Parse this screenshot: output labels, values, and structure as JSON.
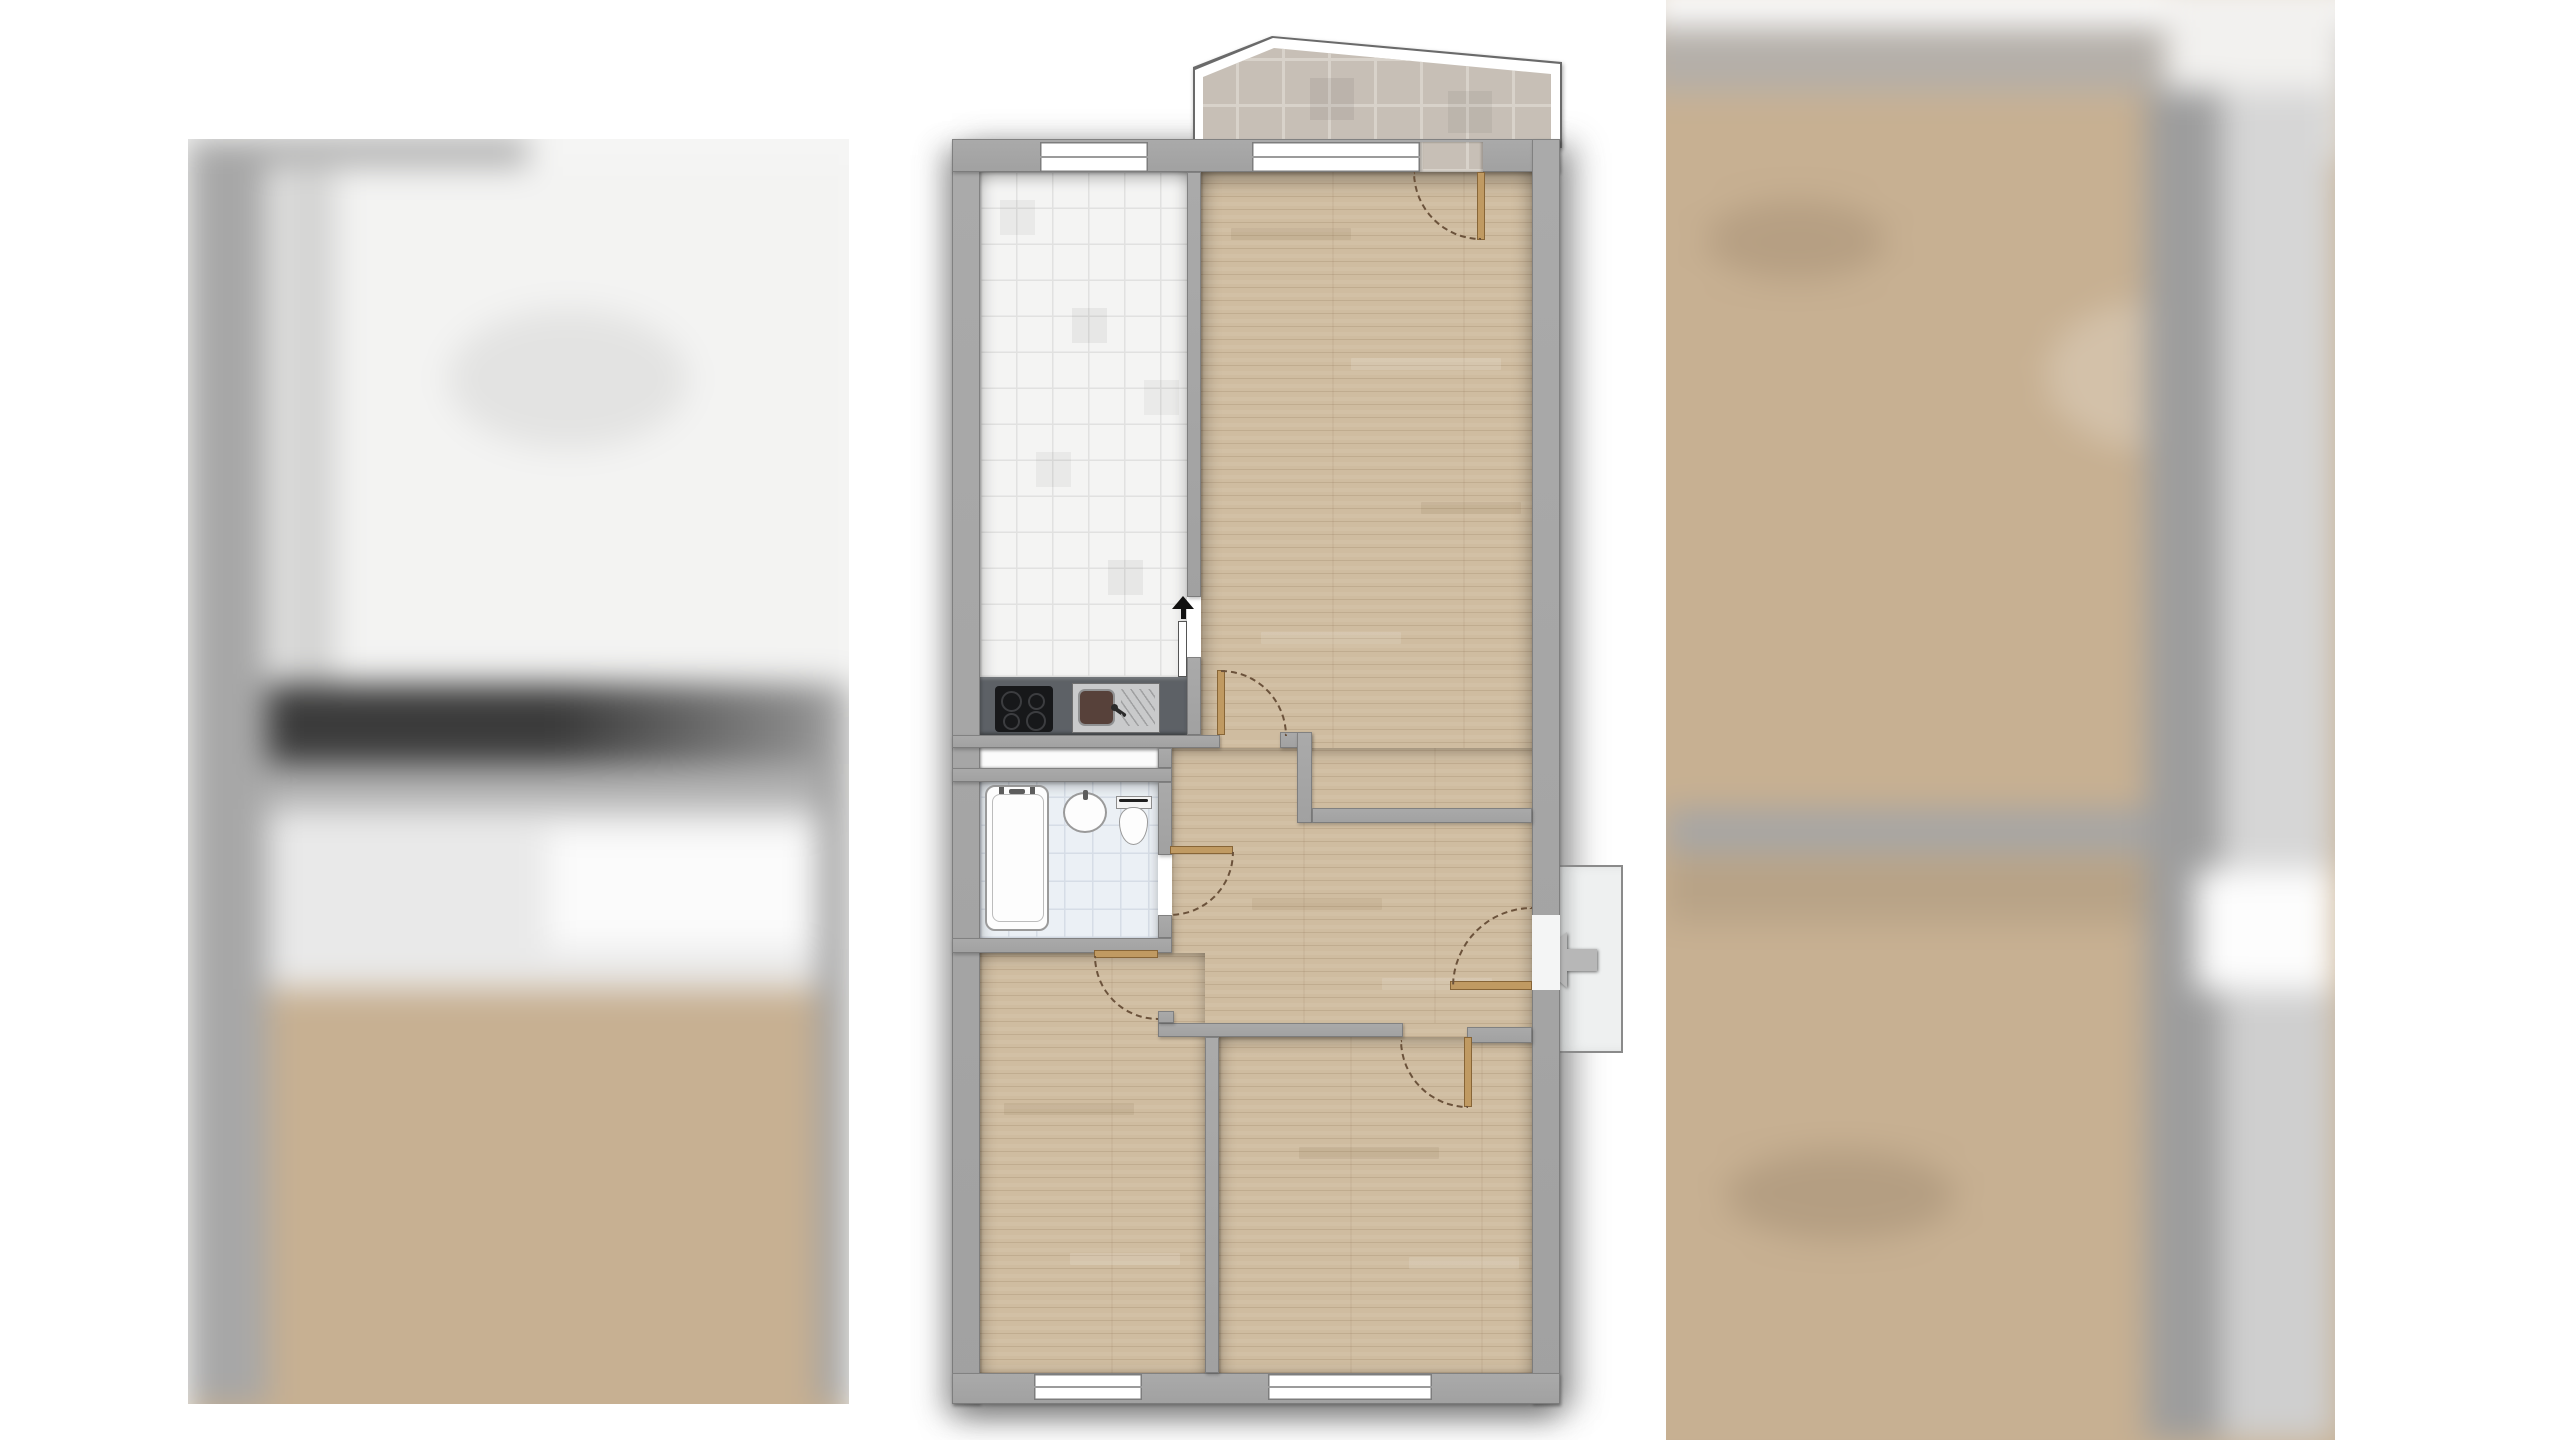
{
  "page": {
    "background": "#ffffff",
    "content": "apartment floor plan shown in an image gallery between two blurred neighbouring images"
  },
  "gallery": {
    "left_thumbnail": {
      "description": "blurred floor plan image (kitchen counter and wood rooms visible as colour blobs)"
    },
    "right_thumbnail": {
      "description": "blurred floor plan image (wood rooms and grey walls visible as colour blobs)"
    }
  },
  "floorplan": {
    "rooms": [
      {
        "id": "balcony",
        "floor": "beige ceramic tiles",
        "position": "top, outside main outline, slanted white railing"
      },
      {
        "id": "kitchen",
        "floor": "white tiles",
        "position": "top-left",
        "fixtures": [
          "counter",
          "cooktop",
          "kitchen-sink"
        ]
      },
      {
        "id": "living-room",
        "floor": "wood parquet",
        "position": "top-right"
      },
      {
        "id": "bathroom",
        "floor": "blue-grey tiles",
        "position": "middle-left",
        "fixtures": [
          "bathtub",
          "washbasin",
          "toilet"
        ]
      },
      {
        "id": "hallway",
        "floor": "wood parquet",
        "position": "middle-right"
      },
      {
        "id": "room-bottom-left",
        "floor": "wood parquet",
        "position": "bottom-left"
      },
      {
        "id": "room-bottom-right",
        "floor": "wood parquet",
        "position": "bottom-right"
      }
    ],
    "windows": [
      {
        "id": "kitchen-window",
        "wall": "top"
      },
      {
        "id": "living-room-window",
        "wall": "top"
      },
      {
        "id": "room-bottom-left-window",
        "wall": "bottom"
      },
      {
        "id": "room-bottom-right-window",
        "wall": "bottom"
      }
    ],
    "doors": [
      {
        "id": "balcony-door",
        "type": "swing",
        "from": "living-room",
        "to": "balcony"
      },
      {
        "id": "kitchen-sliding-door",
        "type": "sliding",
        "from": "living-room",
        "to": "kitchen"
      },
      {
        "id": "living-room-door",
        "type": "swing",
        "from": "hallway",
        "to": "living-room"
      },
      {
        "id": "bathroom-door",
        "type": "swing",
        "from": "hallway",
        "to": "bathroom"
      },
      {
        "id": "room-bottom-left-door",
        "type": "swing",
        "from": "hallway",
        "to": "room-bottom-left"
      },
      {
        "id": "room-bottom-right-door",
        "type": "swing",
        "from": "hallway",
        "to": "room-bottom-right"
      },
      {
        "id": "entrance-door",
        "type": "swing",
        "from": "stair-landing",
        "to": "hallway"
      }
    ],
    "icons": [
      {
        "id": "entrance-arrow-icon",
        "meaning": "entrance direction, grey arrow pointing left into the apartment"
      },
      {
        "id": "sliding-door-arrow-icon",
        "meaning": "small black arrow pointing up at kitchen sliding door"
      }
    ],
    "outside": [
      {
        "id": "stair-landing",
        "description": "light grey platform outside the entrance door"
      }
    ]
  },
  "colors": {
    "white": "#ffffff",
    "wall": "#a1a1a1",
    "wood": "#cfbca0",
    "kitchenTile": "#f4f4f3",
    "kitchenGrid": "#e1e1e0",
    "bathTile": "#ebf0f5",
    "bathGrid": "#d6dde6",
    "balconyTile": "#c7bfb6",
    "balconyGrout": "#d8d2ca",
    "counter": "#5d6166",
    "cooktop": "#17181a",
    "stainless": "#c9cacb",
    "basin": "#57413a",
    "door": "#c09a62",
    "arc": "#6b523b",
    "fixture": "#fdfdfd",
    "fixtureEdge": "#9a9a9a",
    "platform": "#eef0f0",
    "platformEdge": "#8a8a8a",
    "arrow": "#b7b7b7",
    "blurWall": "#a7a7a7",
    "blurWood": "#c9b294",
    "blurDark": "#3b3b3b"
  }
}
